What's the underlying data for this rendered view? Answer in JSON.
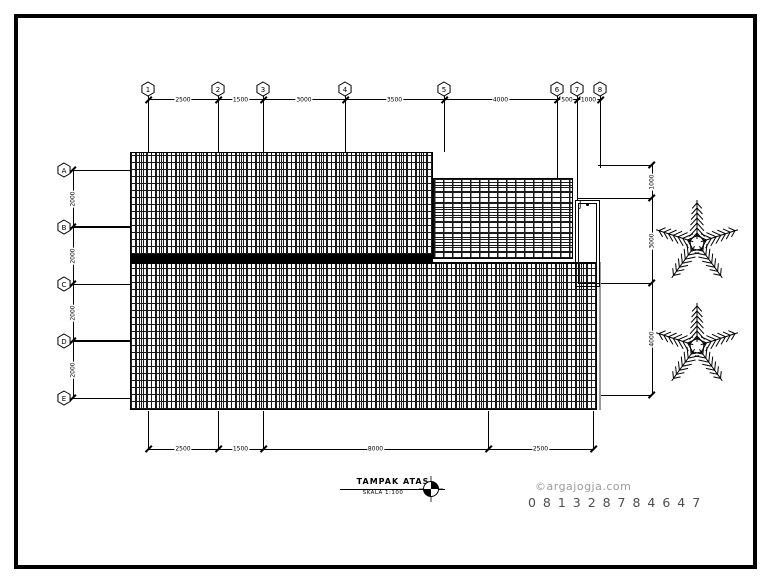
{
  "page": {
    "background": "#ffffff",
    "border_color": "#000000",
    "line_color": "#000000"
  },
  "title_block": {
    "title": "TAMPAK ATAS",
    "scale": "SKALA 1:100",
    "north_icon": "compass-quadrant"
  },
  "grids": {
    "top": {
      "bubbles": [
        "1",
        "2",
        "3",
        "4",
        "5",
        "6",
        "7",
        "8"
      ],
      "dims": [
        "2500",
        "1500",
        "3000",
        "3500",
        "4000",
        "500",
        "1000"
      ]
    },
    "left": {
      "bubbles": [
        "A",
        "B",
        "C",
        "D",
        "E"
      ],
      "dims": [
        "2000",
        "2000",
        "2000",
        "2000"
      ]
    }
  },
  "dimensions": {
    "right": [
      "1000",
      "3000",
      "4000"
    ],
    "bottom": [
      "2500",
      "1500",
      "8000",
      "2500"
    ]
  },
  "annotations": {
    "hook_symbol": "ʃ"
  },
  "landscape": {
    "tree_icon": "palm-tree-plan",
    "tree_count": 2
  },
  "watermark": {
    "site": "©argajogja.com",
    "phone": "0 8 1 3 2 8 7 8 4 6 4 7",
    "site_color": "#9b9b9b",
    "phone_color": "#4d4d4d"
  }
}
